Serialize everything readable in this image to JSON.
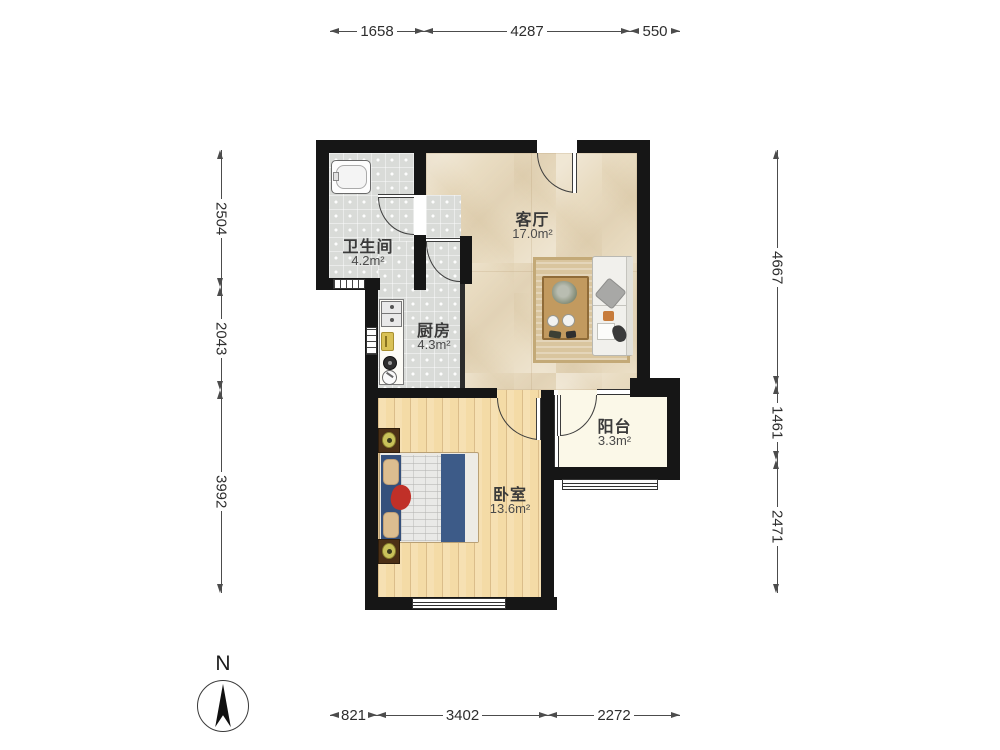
{
  "rooms": {
    "bathroom": {
      "name": "卫生间",
      "area": "4.2m²"
    },
    "kitchen": {
      "name": "厨房",
      "area": "4.3m²"
    },
    "living": {
      "name": "客厅",
      "area": "17.0m²"
    },
    "bedroom": {
      "name": "卧室",
      "area": "13.6m²"
    },
    "balcony": {
      "name": "阳台",
      "area": "3.3m²"
    }
  },
  "dimensions": {
    "top": [
      "1658",
      "4287",
      "550"
    ],
    "bottom": [
      "821",
      "3402",
      "2272"
    ],
    "left": [
      "2504",
      "2043",
      "3992"
    ],
    "right": [
      "4667",
      "1461",
      "2471"
    ]
  },
  "compass": {
    "label": "N"
  },
  "palette": {
    "wall": "#161616",
    "tile_floor": "#d9dbd8",
    "marble_floor": "#e9dcc2",
    "wood_floor": "#f4dba6",
    "balcony_floor": "#fbf8e8",
    "bed_blanket": "#3d5b88",
    "rug": "#d9c59e",
    "dimension_text": "#2e2e2e"
  }
}
